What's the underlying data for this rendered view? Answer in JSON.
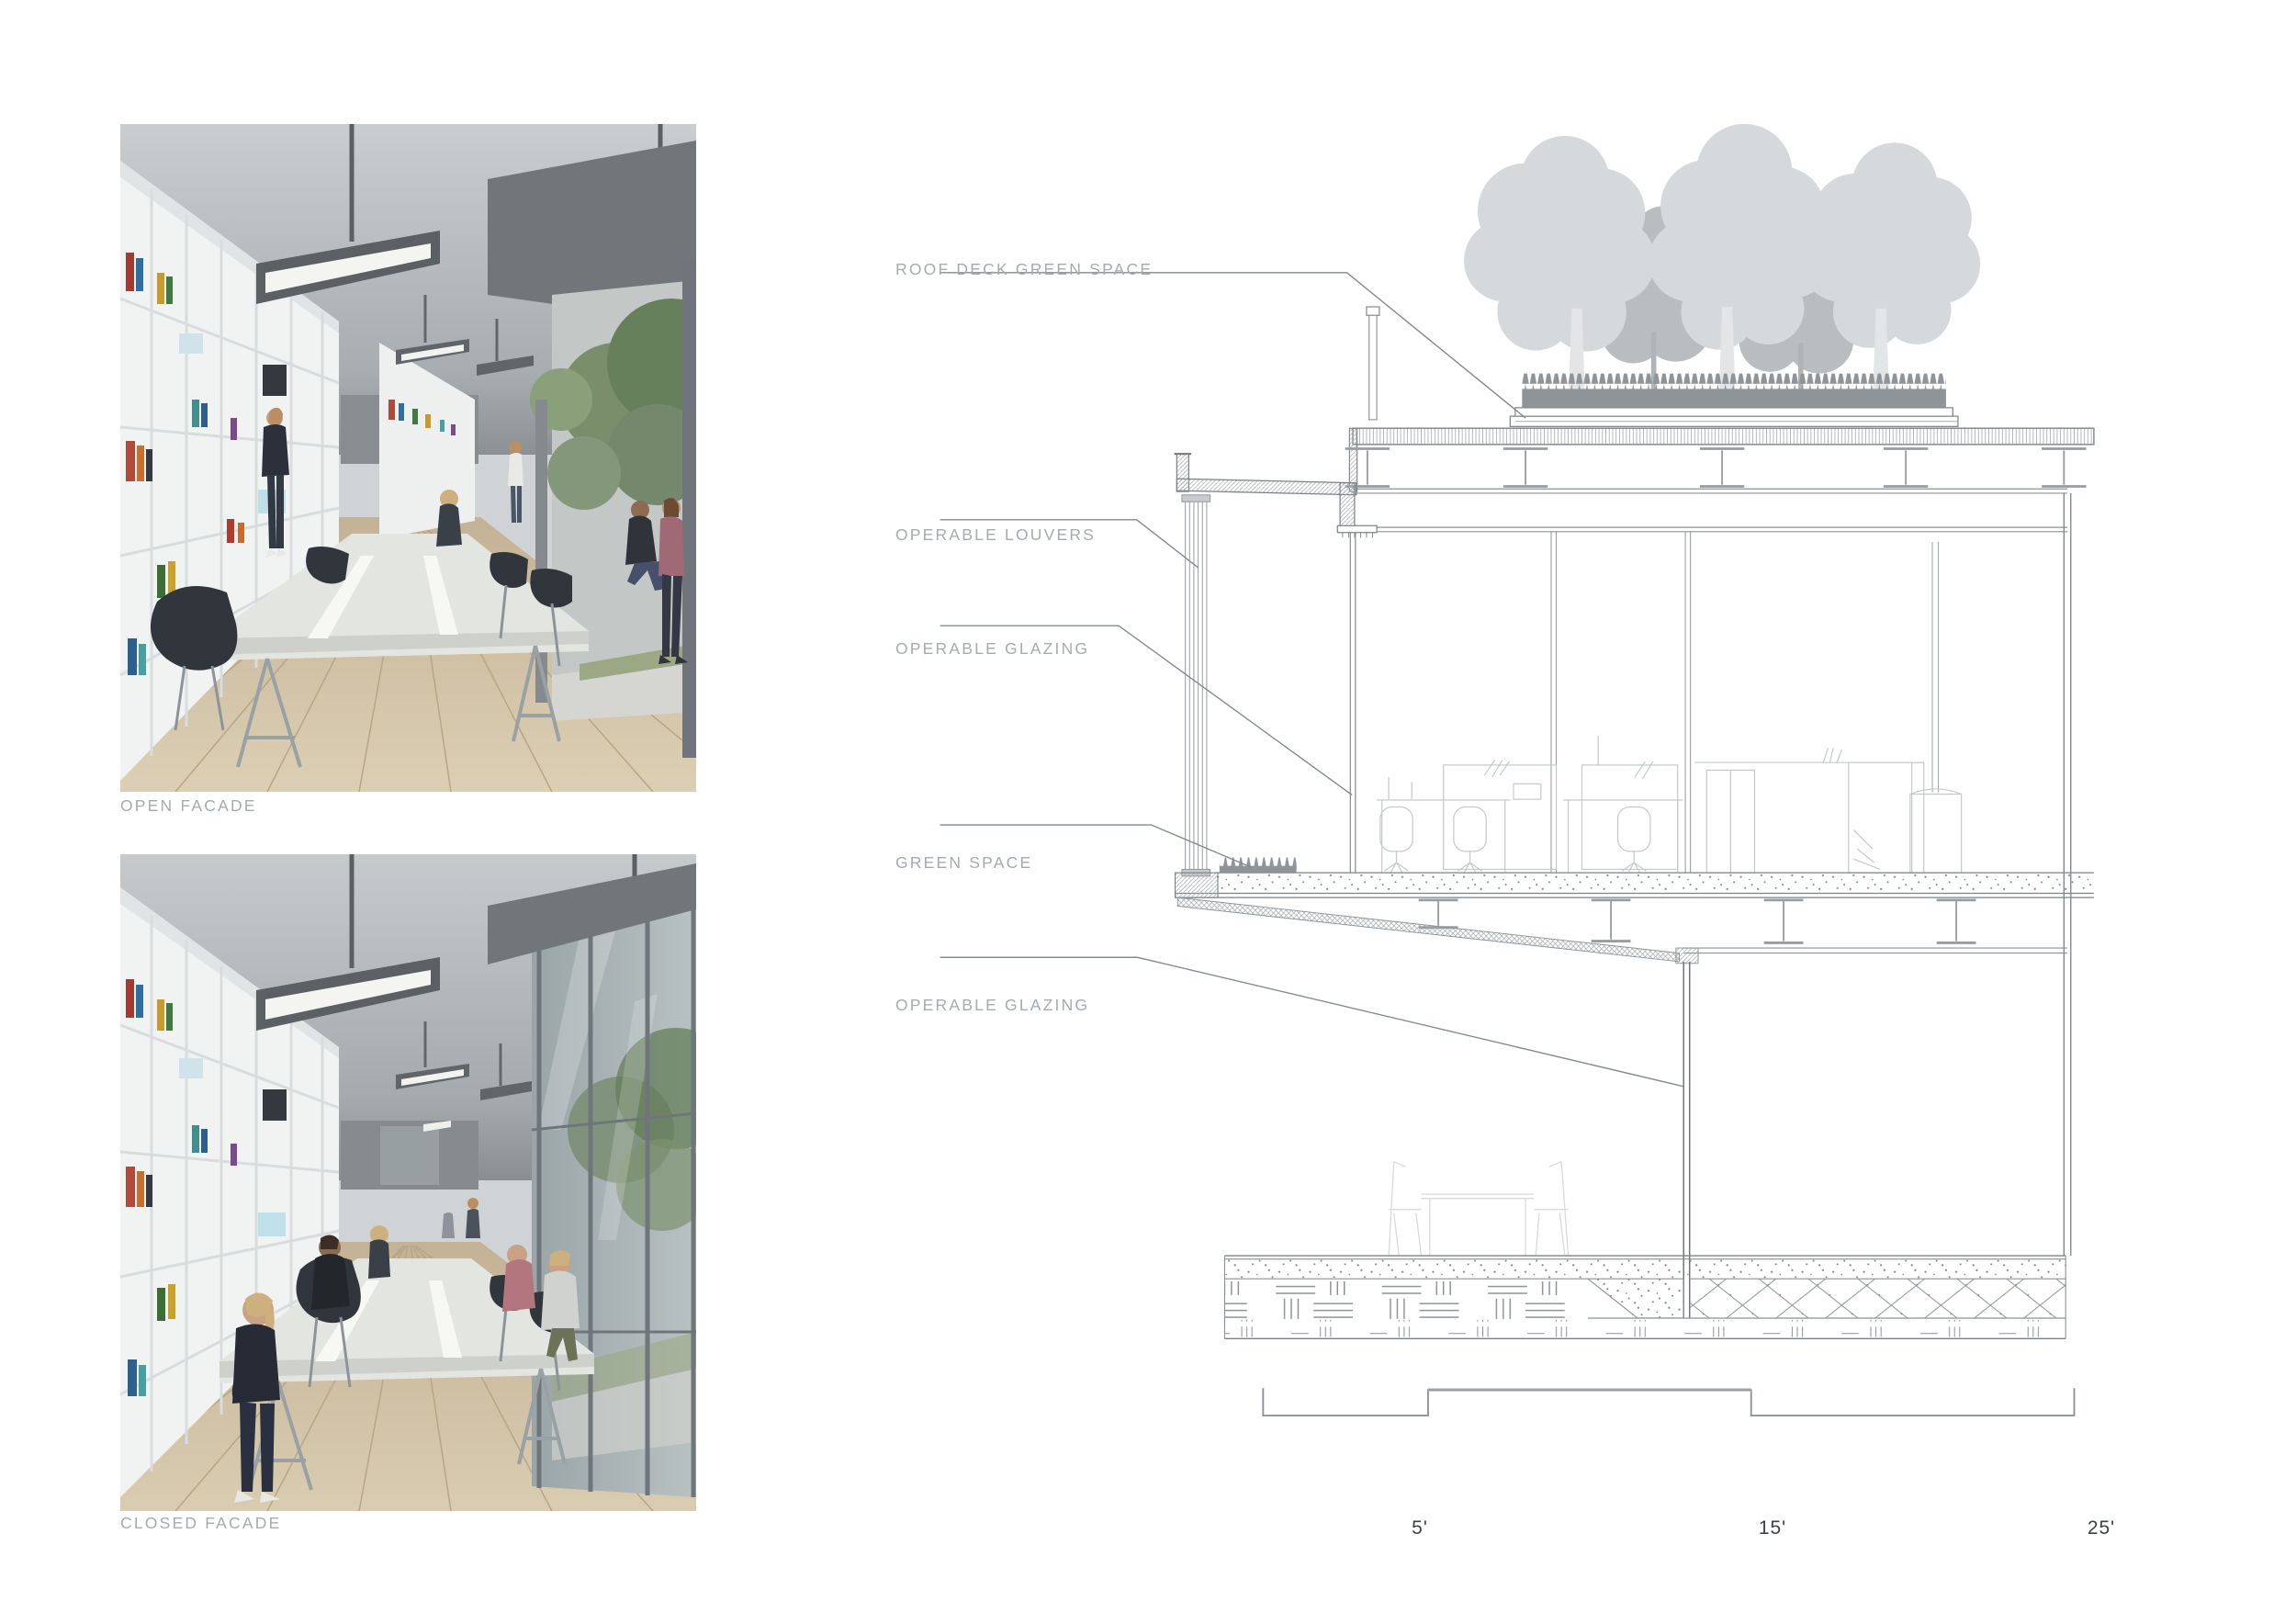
{
  "renderings": [
    {
      "id": "open-facade",
      "caption": "OPEN FACADE"
    },
    {
      "id": "closed-facade",
      "caption": "CLOSED FACADE"
    }
  ],
  "section": {
    "callouts": [
      {
        "label": "ROOF DECK GREEN SPACE"
      },
      {
        "label": "OPERABLE LOUVERS"
      },
      {
        "label": "OPERABLE GLAZING"
      },
      {
        "label": "GREEN SPACE"
      },
      {
        "label": "OPERABLE GLAZING"
      }
    ],
    "scale_bar": {
      "labels": [
        "5'",
        "15'",
        "25'"
      ]
    }
  },
  "colors": {
    "label_text": "#a6abaf",
    "scale_text": "#3e4246",
    "drawing_line": "#8d9296",
    "tree_light": "#d6d9db",
    "tree_dark": "#b9bdc0",
    "grass": "#8f9499"
  }
}
